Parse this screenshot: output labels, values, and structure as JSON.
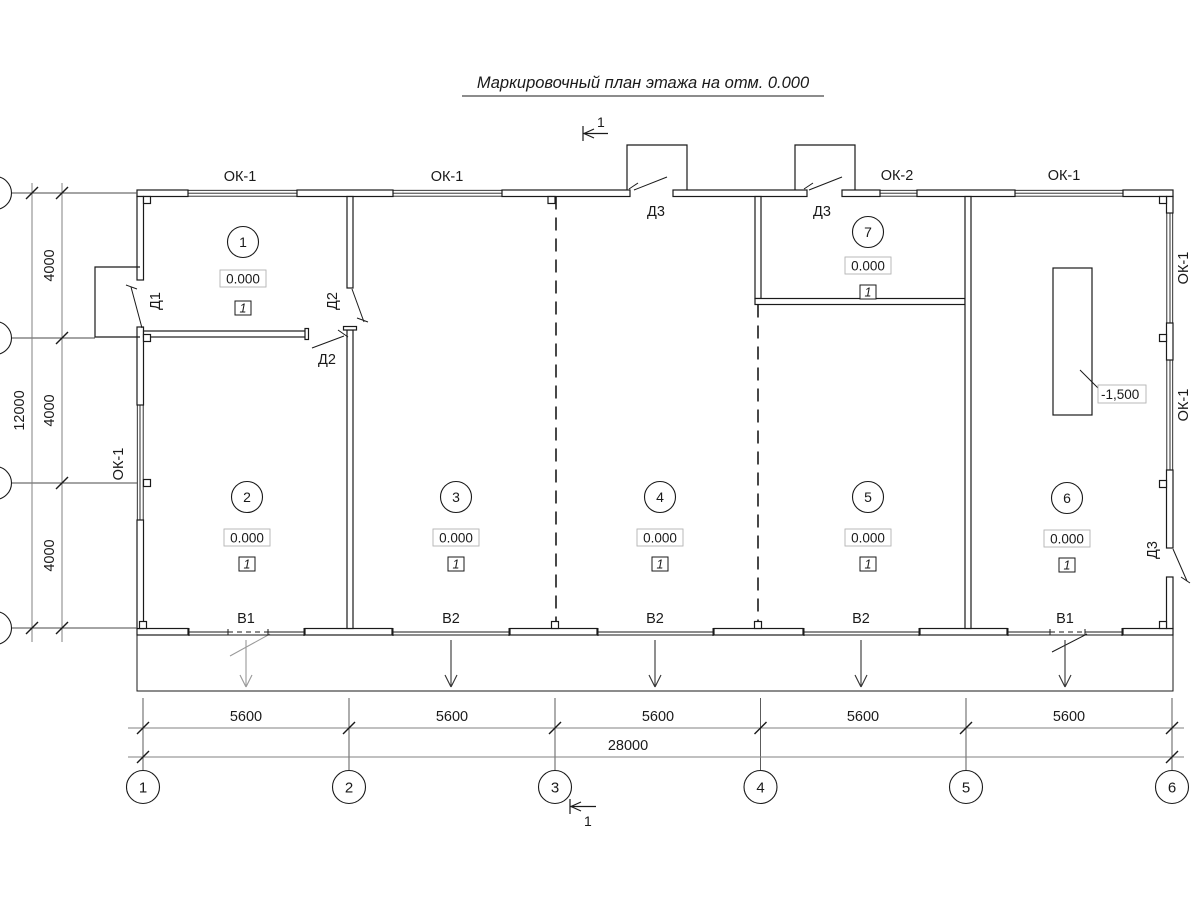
{
  "title": "Маркировочный план этажа на отм. 0.000",
  "section": {
    "top_label": "1",
    "bottom_label": "1"
  },
  "windows": {
    "top_labels": [
      "ОК-1",
      "ОК-1",
      "ОК-2",
      "ОК-1"
    ],
    "left_label": "ОК-1",
    "right_labels": [
      "ОК-1",
      "ОК-1"
    ]
  },
  "doors": {
    "d1": "Д1",
    "d2_upper": "Д2",
    "d2_lower": "Д2",
    "d3_porch1": "Д3",
    "d3_porch2": "Д3",
    "d3_right": "Д3"
  },
  "rooms": [
    {
      "number": "1",
      "elevation": "0.000",
      "floor_type": "1"
    },
    {
      "number": "2",
      "elevation": "0.000",
      "floor_type": "1"
    },
    {
      "number": "3",
      "elevation": "0.000",
      "floor_type": "1"
    },
    {
      "number": "4",
      "elevation": "0.000",
      "floor_type": "1"
    },
    {
      "number": "5",
      "elevation": "0.000",
      "floor_type": "1"
    },
    {
      "number": "6",
      "elevation": "0.000",
      "floor_type": "1"
    },
    {
      "number": "7",
      "elevation": "0.000",
      "floor_type": "1"
    }
  ],
  "gates": [
    "В1",
    "В2",
    "В2",
    "В2",
    "В1"
  ],
  "pit": {
    "elevation_label": "-1,500"
  },
  "dimensions": {
    "bay_widths": [
      "5600",
      "5600",
      "5600",
      "5600",
      "5600"
    ],
    "total_width": "28000",
    "row_heights": [
      "4000",
      "4000",
      "4000"
    ],
    "total_height": "12000"
  },
  "axes": [
    "1",
    "2",
    "3",
    "4",
    "5",
    "6"
  ]
}
